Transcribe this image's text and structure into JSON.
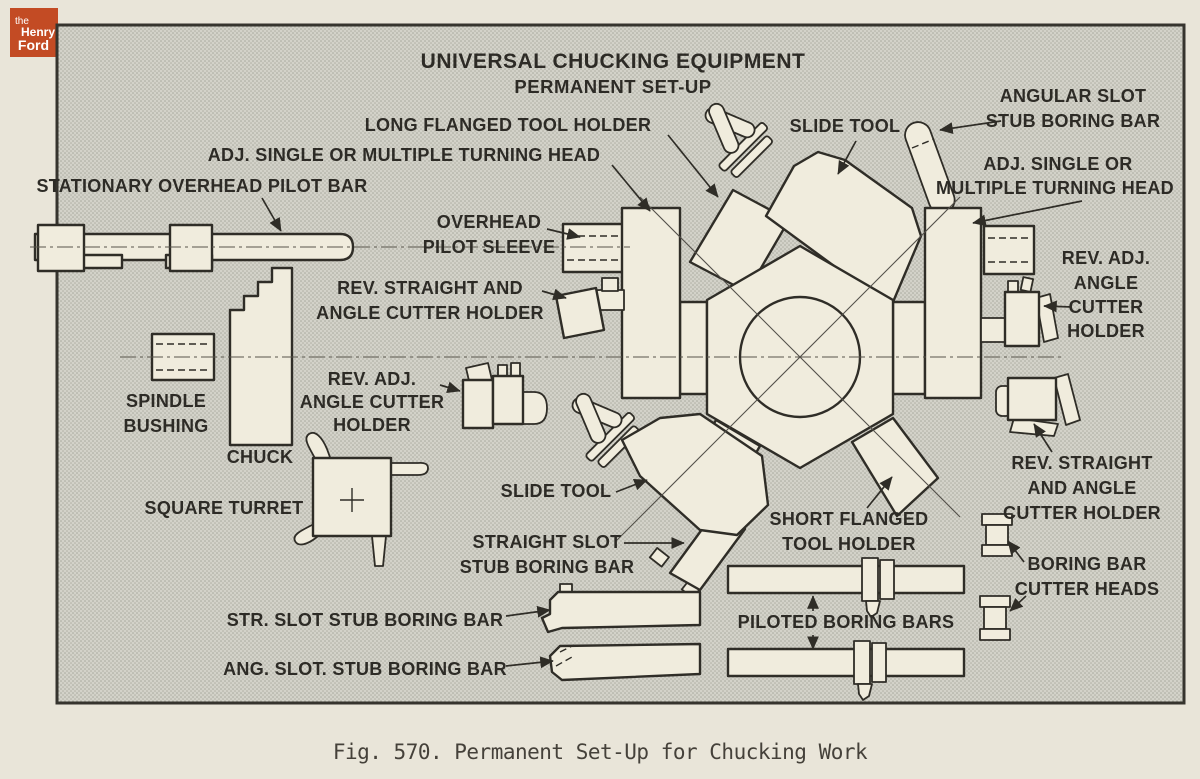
{
  "colors": {
    "page": "#E9E5D9",
    "panel": "#D3D2C9",
    "ink": "#2F2D27",
    "shape_fill": "#F0ECDD",
    "logo_orange": "#C34B24",
    "caption_ink": "#45413A"
  },
  "logo": {
    "the": "the",
    "henry": "Henry",
    "ford": "Ford"
  },
  "diagram": {
    "title": "UNIVERSAL CHUCKING EQUIPMENT",
    "subtitle": "PERMANENT SET-UP",
    "labels": {
      "long_flanged_tool_holder": {
        "lines": [
          "LONG FLANGED TOOL HOLDER"
        ]
      },
      "adj_turning_head_left": {
        "lines": [
          "ADJ. SINGLE OR MULTIPLE TURNING HEAD"
        ]
      },
      "stationary_overhead_pilot_bar": {
        "lines": [
          "STATIONARY OVERHEAD PILOT BAR"
        ]
      },
      "slide_tool_top": {
        "lines": [
          "SLIDE TOOL"
        ]
      },
      "angular_slot_stub_boring_bar": {
        "lines": [
          "ANGULAR SLOT",
          "STUB BORING BAR"
        ]
      },
      "adj_turning_head_right": {
        "lines": [
          "ADJ. SINGLE OR",
          "MULTIPLE TURNING HEAD"
        ]
      },
      "overhead_pilot_sleeve": {
        "lines": [
          "OVERHEAD",
          "PILOT SLEEVE"
        ]
      },
      "rev_straight_angle_left": {
        "lines": [
          "REV. STRAIGHT AND",
          "ANGLE CUTTER HOLDER"
        ]
      },
      "rev_adj_angle_right": {
        "lines": [
          "REV. ADJ.",
          "ANGLE",
          "CUTTER",
          "HOLDER"
        ]
      },
      "spindle_bushing": {
        "lines": [
          "SPINDLE",
          "BUSHING"
        ]
      },
      "rev_adj_angle_left": {
        "lines": [
          "REV. ADJ.",
          "ANGLE CUTTER",
          "HOLDER"
        ]
      },
      "chuck": {
        "lines": [
          "CHUCK"
        ]
      },
      "square_turret": {
        "lines": [
          "SQUARE TURRET"
        ]
      },
      "slide_tool_bottom": {
        "lines": [
          "SLIDE TOOL"
        ]
      },
      "straight_slot_stub_boring_bar": {
        "lines": [
          "STRAIGHT SLOT",
          "STUB BORING BAR"
        ]
      },
      "short_flanged_tool_holder": {
        "lines": [
          "SHORT FLANGED",
          "TOOL HOLDER"
        ]
      },
      "rev_straight_angle_right": {
        "lines": [
          "REV. STRAIGHT",
          "AND ANGLE",
          "CUTTER HOLDER"
        ]
      },
      "str_slot_stub_boring_bar": {
        "lines": [
          "STR. SLOT STUB BORING BAR"
        ]
      },
      "piloted_boring_bars": {
        "lines": [
          "PILOTED BORING BARS"
        ]
      },
      "boring_bar_cutter_heads": {
        "lines": [
          "BORING BAR",
          "CUTTER HEADS"
        ]
      },
      "ang_slot_stub_boring_bar": {
        "lines": [
          "ANG. SLOT. STUB BORING BAR"
        ]
      }
    }
  },
  "caption": "Fig. 570.  Permanent Set-Up for Chucking Work"
}
